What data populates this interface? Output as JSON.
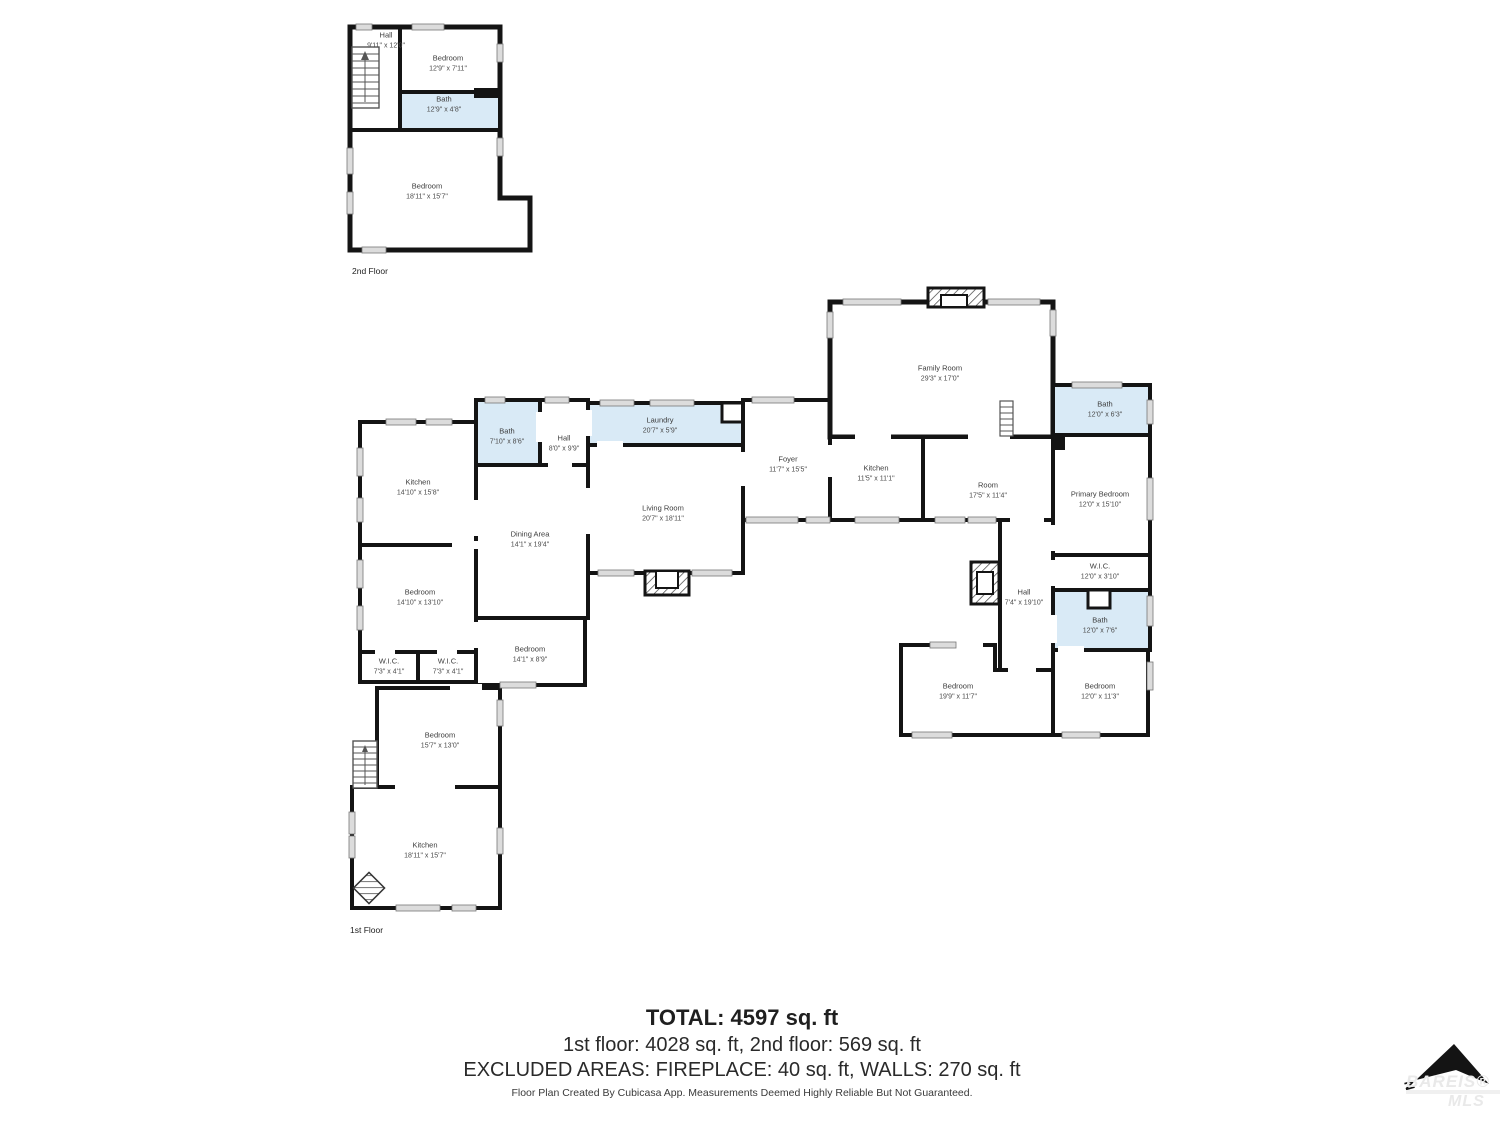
{
  "floors": {
    "second": {
      "label": "2nd Floor",
      "rooms": [
        {
          "name": "Hall",
          "dims": "9'11\" x 12'0\""
        },
        {
          "name": "Bedroom",
          "dims": "12'9\" x 7'11\""
        },
        {
          "name": "Bath",
          "dims": "12'9\" x 4'8\""
        },
        {
          "name": "Bedroom",
          "dims": "18'11\" x 15'7\""
        }
      ]
    },
    "first": {
      "label": "1st Floor",
      "rooms": [
        {
          "name": "Kitchen",
          "dims": "14'10\" x 15'8\""
        },
        {
          "name": "Bath",
          "dims": "7'10\" x 8'6\""
        },
        {
          "name": "Hall",
          "dims": "8'0\" x 9'9\""
        },
        {
          "name": "Laundry",
          "dims": "20'7\" x 5'9\""
        },
        {
          "name": "Dining Area",
          "dims": "14'1\" x 19'4\""
        },
        {
          "name": "Living Room",
          "dims": "20'7\" x 18'11\""
        },
        {
          "name": "Foyer",
          "dims": "11'7\" x 15'5\""
        },
        {
          "name": "Family Room",
          "dims": "29'3\" x 17'0\""
        },
        {
          "name": "Kitchen",
          "dims": "11'5\" x 11'1\""
        },
        {
          "name": "Room",
          "dims": "17'5\" x 11'4\""
        },
        {
          "name": "Bath",
          "dims": "12'0\" x 6'3\""
        },
        {
          "name": "Primary Bedroom",
          "dims": "12'0\" x 15'10\""
        },
        {
          "name": "W.I.C.",
          "dims": "12'0\" x 3'10\""
        },
        {
          "name": "Bath",
          "dims": "12'0\" x 7'6\""
        },
        {
          "name": "Hall",
          "dims": "7'4\" x 19'10\""
        },
        {
          "name": "Bedroom",
          "dims": "14'10\" x 13'10\""
        },
        {
          "name": "W.I.C.",
          "dims": "7'3\" x 4'1\""
        },
        {
          "name": "W.I.C.",
          "dims": "7'3\" x 4'1\""
        },
        {
          "name": "Bedroom",
          "dims": "14'1\" x 8'9\""
        },
        {
          "name": "Bedroom",
          "dims": "19'9\" x 11'7\""
        },
        {
          "name": "Bedroom",
          "dims": "12'0\" x 11'3\""
        },
        {
          "name": "Bedroom",
          "dims": "15'7\" x 13'0\""
        },
        {
          "name": "Kitchen",
          "dims": "18'11\" x 15'7\""
        }
      ]
    }
  },
  "summary": {
    "total": "TOTAL: 4597 sq. ft",
    "floors_line": "1st floor: 4028 sq. ft, 2nd floor: 569 sq. ft",
    "excluded_line": "EXCLUDED AREAS: FIREPLACE: 40 sq. ft, WALLS: 270 sq. ft"
  },
  "footer": "Floor Plan Created By Cubicasa App. Measurements Deemed Highly Reliable But Not Guaranteed.",
  "compass": {
    "label": "N"
  },
  "watermark": {
    "line1": "BAREIS®",
    "line2": "MLS"
  },
  "colors": {
    "wall": "#141414",
    "wet_room_fill": "#d9eaf6",
    "floor_fill": "#ffffff",
    "window": "#dcdcdc"
  }
}
